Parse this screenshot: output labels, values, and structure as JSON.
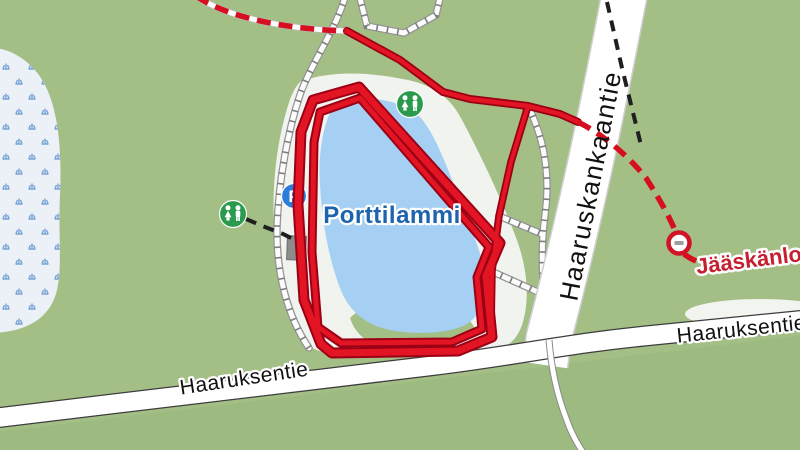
{
  "map": {
    "labels": {
      "lake": "Porttilammi",
      "road_left": "Haaruksentie",
      "road_right": "Haaruksentie",
      "road_vertical": "Haaruskankaantie",
      "destination": "Jääskänlon",
      "parking_letter": "P"
    },
    "colors": {
      "background_green": "#a4bf86",
      "lower_field_green": "#9dbb80",
      "marsh_fill": "#ebf1f7",
      "marsh_symbol_blue": "#79a3d6",
      "lake_blue": "#a5d0f3",
      "clearing_white": "#f1f3ef",
      "road_white": "#ffffff",
      "road_casing_gray": "#cfcfcf",
      "road_edge_dark": "#3d3d3d",
      "trail_casing": "#949494",
      "trail_tick": "#7d7d7d",
      "route_red": "#e31423",
      "route_red_dark": "#9b0014",
      "route_dashed_red": "#d50f20",
      "path_dashed_black": "#1f1f1f",
      "wc_icon_green": "#2a9a4d",
      "parking_icon_blue": "#2e7cd9",
      "building_gray": "#8c8c8c",
      "no_entry_ring_red": "#d01326",
      "no_entry_bar_gray": "#9e9e9e",
      "lake_label_blue": "#1e63ae",
      "destination_label_red": "#c51f30"
    },
    "icons": [
      "wc-icon",
      "wc-icon",
      "parking-icon",
      "no-entry-icon"
    ]
  }
}
